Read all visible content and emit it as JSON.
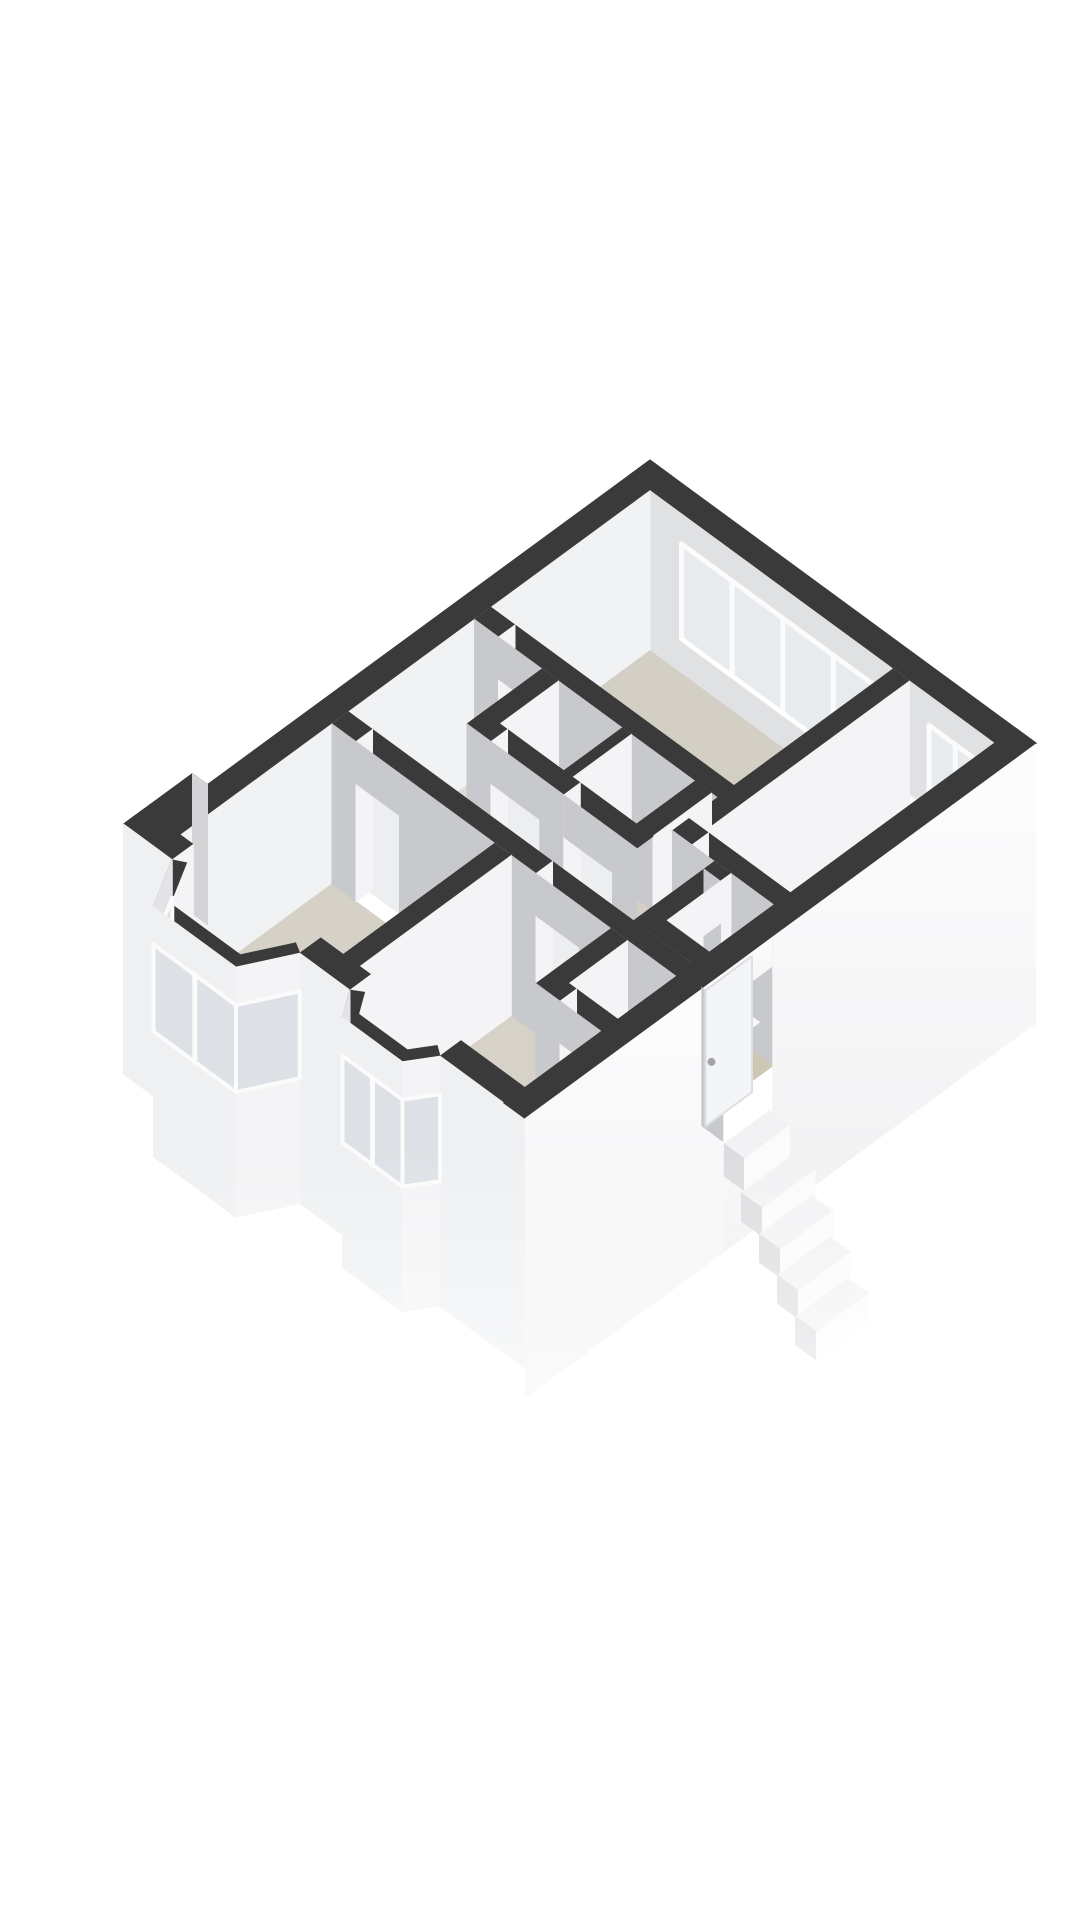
{
  "view": {
    "type": "3d-floorplan-axonometric",
    "background": "#ffffff"
  },
  "palette": {
    "background": "#ffffff",
    "wall_top": "#3a3a3b",
    "wall_face_se": "#f4f4f6",
    "wall_face_sw": "#c8c9cc",
    "ne_window_wall": "#dfe1e3",
    "nw_inner": "#f1f2f4",
    "glass": "#e8ebee",
    "glass_bay": "#dde1e5",
    "frame": "#fbfbfc",
    "floor_bedroom1": "#d4cfc5",
    "floor_bedroom2": "#d7d2c8",
    "floor_living": "#d6d1c7",
    "floor_hall": "#e1ded6",
    "floor_bath": "#cfc7b5",
    "floor_bay": "#dad5cb",
    "door_leaf": "#eceef0",
    "door_leaf_lit": "#f4f5f7",
    "ext_sw": "#eef0f2",
    "ext_sw_angled": "#e3e4e7",
    "ext_se_top": "#fdfdfe",
    "ext_se_bottom": "#f1f1f3",
    "fixture": "#f7f8fa",
    "fixture_shade": "#e9ebee",
    "tub": "#fafbfc",
    "tub_inner": "#e9ebed",
    "step": "#f2f2f4",
    "stair_side": "#dcdce0",
    "handle": "#a3a5a8",
    "notch_face": "#d4d4d7"
  },
  "rooms": [
    {
      "name": "bedroom-1",
      "position": "top",
      "floor_color": "#d4cfc5"
    },
    {
      "name": "bathroom",
      "position": "right",
      "floor_color": "#cfc7b5"
    },
    {
      "name": "toilet",
      "position": "right-lower",
      "floor_color": "#cfc7b5"
    },
    {
      "name": "hall",
      "position": "center",
      "floor_color": "#e1ded6"
    },
    {
      "name": "closet-a",
      "position": "center",
      "floor_color": "#d4cfc5"
    },
    {
      "name": "closet-b",
      "position": "center",
      "floor_color": "#d4cfc5"
    },
    {
      "name": "living-room",
      "position": "left",
      "floor_color": "#d6d1c7"
    },
    {
      "name": "bedroom-2",
      "position": "bottom",
      "floor_color": "#d7d2c8"
    },
    {
      "name": "bedroom-2-closet",
      "position": "bottom",
      "floor_color": "#d7d2c8"
    }
  ],
  "windows": [
    {
      "wall": "north-east",
      "room": "bedroom-1",
      "panes": 4
    },
    {
      "wall": "north-east",
      "room": "bathroom",
      "panes": 2
    },
    {
      "wall": "south-west",
      "room": "living-room",
      "type": "bay",
      "panes": 4
    },
    {
      "wall": "south-west",
      "room": "bedroom-2",
      "type": "bay",
      "panes": 4
    }
  ],
  "fixtures": [
    {
      "type": "bathtub",
      "room": "bathroom"
    },
    {
      "type": "washbasin-vanity",
      "room": "bathroom"
    },
    {
      "type": "toilet",
      "room": "toilet"
    },
    {
      "type": "entrance-step",
      "room": "hall"
    },
    {
      "type": "front-door",
      "wall": "south-east",
      "handle": true
    },
    {
      "type": "exterior-staircase",
      "steps": 4
    }
  ]
}
